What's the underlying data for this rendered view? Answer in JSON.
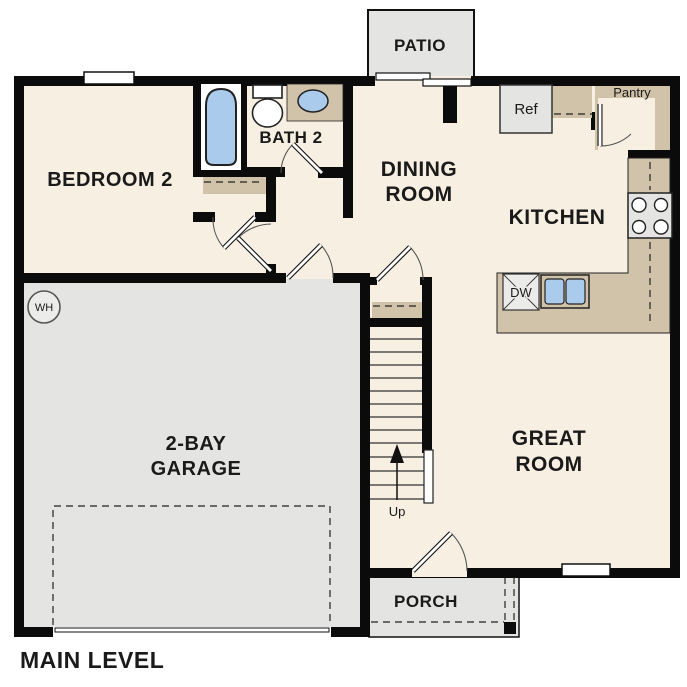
{
  "plan": {
    "title": "MAIN LEVEL",
    "rooms": {
      "bedroom2": "BEDROOM 2",
      "bath2": "BATH 2",
      "dining_line1": "DINING",
      "dining_line2": "ROOM",
      "kitchen": "KITCHEN",
      "great_line1": "GREAT",
      "great_line2": "ROOM",
      "garage_line1": "2-BAY",
      "garage_line2": "GARAGE"
    },
    "outdoor": {
      "patio": "PATIO",
      "porch": "PORCH"
    },
    "labels": {
      "ref": "Ref",
      "pantry": "Pantry",
      "dishwasher": "DW",
      "water_heater": "WH",
      "stairs_up": "Up"
    },
    "colors": {
      "floor_cream": "#f7efe2",
      "garage_gray": "#e4e4e2",
      "cabinet_tan": "#d1c3a9",
      "fixture_blue": "#abcbec",
      "wall_black": "#0b0b0b",
      "background": "#ffffff"
    }
  }
}
